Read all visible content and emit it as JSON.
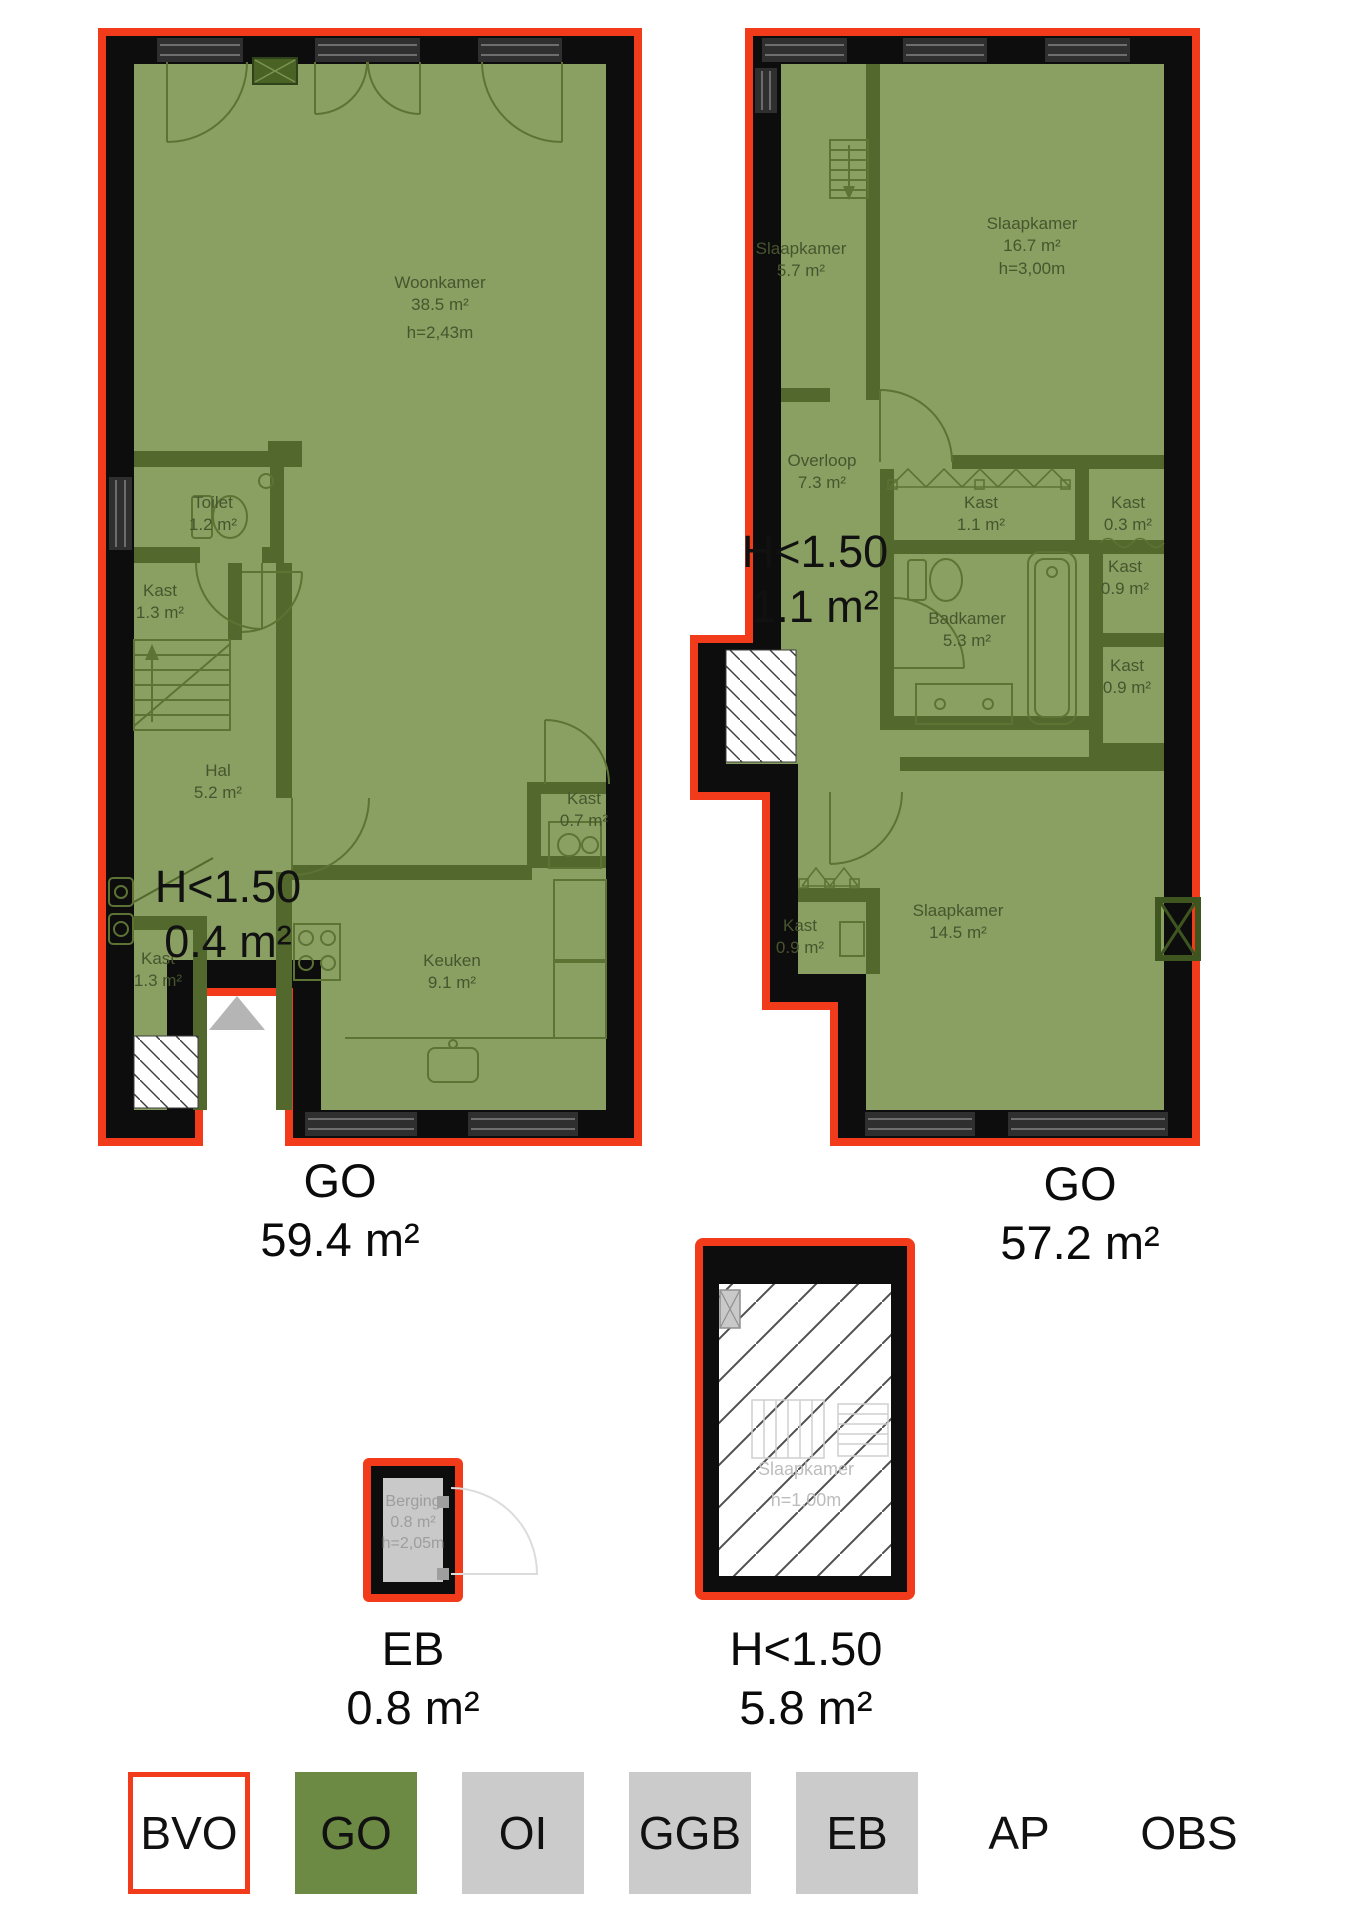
{
  "document_type": "floorplan",
  "colors": {
    "outline_red": "#f23b1b",
    "go_area_green": "#8aa063",
    "legend_go_green": "#6d8a45",
    "legend_grey": "#cbcbcb",
    "wall_black": "#0d0d0d"
  },
  "floor1": {
    "rooms": {
      "woonkamer": {
        "name": "Woonkamer",
        "area": "38.5 m²",
        "height": "h=2,43m"
      },
      "toilet": {
        "name": "Toilet",
        "area": "1.2 m²"
      },
      "kast_hal_boven": {
        "name": "Kast",
        "area": "1.3 m²"
      },
      "hal": {
        "name": "Hal",
        "area": "5.2 m²"
      },
      "kast_hal_onder": {
        "name": "Kast",
        "area": "1.3 m²"
      },
      "keuken": {
        "name": "Keuken",
        "area": "9.1 m²"
      },
      "kast_keuken": {
        "name": "Kast",
        "area": "0.7 m²"
      }
    },
    "low_height_note": {
      "line1": "H<1.50",
      "line2": "0.4 m²"
    },
    "caption": {
      "code": "GO",
      "area": "59.4 m²"
    }
  },
  "floor2": {
    "rooms": {
      "slaapkamer_klein": {
        "name": "Slaapkamer",
        "area": "5.7 m²"
      },
      "slaapkamer_groot": {
        "name": "Slaapkamer",
        "area": "16.7 m²",
        "height": "h=3,00m"
      },
      "overloop": {
        "name": "Overloop",
        "area": "7.3 m²"
      },
      "kast_11": {
        "name": "Kast",
        "area": "1.1 m²"
      },
      "kast_03": {
        "name": "Kast",
        "area": "0.3 m²"
      },
      "kast_09_boven": {
        "name": "Kast",
        "area": "0.9 m²"
      },
      "badkamer": {
        "name": "Badkamer",
        "area": "5.3 m²"
      },
      "kast_09_midden": {
        "name": "Kast",
        "area": "0.9 m²"
      },
      "kast_09_onder": {
        "name": "Kast",
        "area": "0.9 m²"
      },
      "slaapkamer_achter": {
        "name": "Slaapkamer",
        "area": "14.5 m²"
      }
    },
    "low_height_note": {
      "line1": "H<1.50",
      "line2": "1.1 m²"
    },
    "caption": {
      "code": "GO",
      "area": "57.2 m²"
    }
  },
  "storage": {
    "room": {
      "name": "Berging",
      "area": "0.8 m²",
      "height": "h=2,05m"
    },
    "caption": {
      "code": "EB",
      "area": "0.8 m²"
    }
  },
  "attic": {
    "room": {
      "name": "Slaapkamer",
      "height": "h=1,00m"
    },
    "caption": {
      "code": "H<1.50",
      "area": "5.8 m²"
    }
  },
  "legend": {
    "items": [
      {
        "label": "BVO",
        "style": "bvo"
      },
      {
        "label": "GO",
        "style": "go"
      },
      {
        "label": "OI",
        "style": "grey"
      },
      {
        "label": "GGB",
        "style": "grey"
      },
      {
        "label": "EB",
        "style": "grey"
      },
      {
        "label": "AP",
        "style": "none"
      },
      {
        "label": "OBS",
        "style": "none"
      }
    ]
  }
}
